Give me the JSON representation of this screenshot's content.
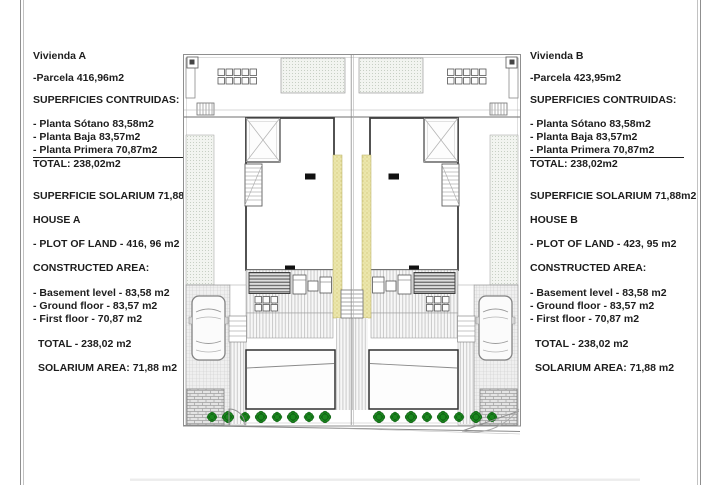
{
  "document": {
    "type": "architectural-site-plan-sheet",
    "plan_units": "m2"
  },
  "panels": [
    {
      "id": "house-a-info",
      "lines": [
        "Vivienda A",
        "-Parcela 416,96m2",
        "SUPERFICIES CONTRUIDAS:",
        "- Planta Sótano 83,58m2",
        "- Planta Baja 83,57m2",
        "- Planta Primera 70,87m2",
        "TOTAL: 238,02m2",
        "SUPERFICIE SOLARIUM 71,88m2",
        "HOUSE A",
        "- PLOT OF LAND - 416, 96 m2",
        "CONSTRUCTED AREA:",
        "- Basement level - 83,58 m2",
        "- Ground floor - 83,57 m2",
        "- First floor - 70,87 m2",
        "TOTAL - 238,02 m2",
        "SOLARIUM AREA: 71,88 m2"
      ]
    },
    {
      "id": "house-b-info",
      "lines": [
        "Vivienda B",
        "-Parcela 423,95m2",
        "SUPERFICIES CONTRUIDAS:",
        "- Planta Sótano 83,58m2",
        "- Planta Baja 83,57m2",
        "- Planta Primera 70,87m2",
        "TOTAL: 238,02m2",
        "SUPERFICIE SOLARIUM 71,88m2",
        "HOUSE B",
        "- PLOT OF LAND - 423, 95 m2",
        "CONSTRUCTED AREA:",
        "- Basement level - 83,58 m2",
        "- Ground floor - 83,57 m2",
        "- First floor - 70,87 m2",
        "TOTAL - 238,02 m2",
        "SOLARIUM AREA: 71,88 m2"
      ]
    }
  ],
  "plan": {
    "features": [
      "semi-detached-roof-plan",
      "party-wall",
      "solarium-roof",
      "skylight-x",
      "staircase",
      "terrace",
      "awning",
      "car-icon",
      "driveway",
      "pool",
      "shrub-icon",
      "gate-swing",
      "brick-pillar"
    ],
    "colors": {
      "party_wall_yellow": "#ebe6ab",
      "shrub_green": "#1b871f",
      "line_gray": "#8f8f8f",
      "outline_dark": "#3f3f3f"
    }
  }
}
